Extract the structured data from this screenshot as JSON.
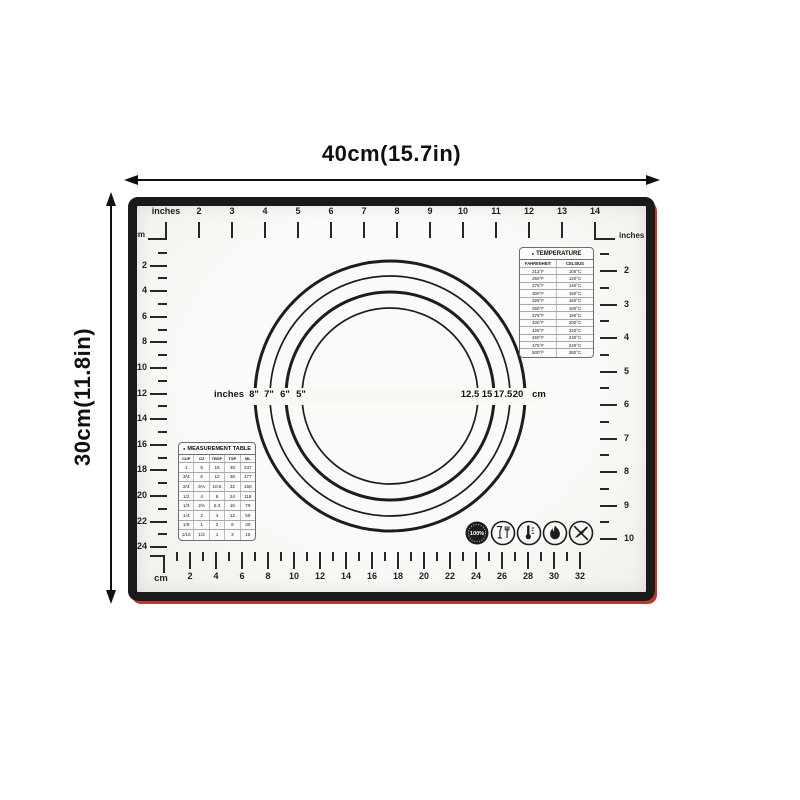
{
  "page": {
    "width_dimension": "40cm(15.7in)",
    "height_dimension": "30cm(11.8in)"
  },
  "mat": {
    "top_ruler": {
      "unit_first": "inches",
      "numbers": [
        2,
        3,
        4,
        5,
        6,
        7,
        8,
        9,
        10,
        11,
        12,
        13,
        14
      ],
      "corner_unit": "cm",
      "right_unit": "inches"
    },
    "left_ruler": {
      "numbers": [
        2,
        4,
        6,
        8,
        10,
        12,
        14,
        16,
        18,
        20,
        22,
        24
      ]
    },
    "right_ruler": {
      "numbers": [
        2,
        3,
        4,
        5,
        6,
        7,
        8,
        9,
        10
      ]
    },
    "bottom_ruler": {
      "unit": "cm",
      "numbers": [
        2,
        4,
        6,
        8,
        10,
        12,
        14,
        16,
        18,
        20,
        22,
        24,
        26,
        28,
        30,
        32
      ]
    },
    "circle_guides": {
      "left_unit": "inches",
      "diameters_inches": [
        "8\"",
        "7\"",
        "6\"",
        "5\""
      ],
      "diameters_cm": [
        "12.5",
        "15",
        "17.5",
        "20"
      ],
      "right_unit": "cm"
    },
    "temperature_table": {
      "bullet": "●",
      "title": "TEMPERATURE",
      "headers": [
        "FAHRENHEIT",
        "CELSIUS"
      ],
      "rows": [
        [
          "212°F",
          "100°C"
        ],
        [
          "250°F",
          "120°C"
        ],
        [
          "275°F",
          "140°C"
        ],
        [
          "300°F",
          "150°C"
        ],
        [
          "325°F",
          "160°C"
        ],
        [
          "350°F",
          "180°C"
        ],
        [
          "375°F",
          "190°C"
        ],
        [
          "400°F",
          "200°C"
        ],
        [
          "425°F",
          "220°C"
        ],
        [
          "450°F",
          "230°C"
        ],
        [
          "475°F",
          "240°C"
        ],
        [
          "500°F",
          "260°C"
        ]
      ]
    },
    "measurement_table": {
      "bullet": "●",
      "title": "MEASUREMENT TABLE",
      "headers": [
        "CUP",
        "OZ",
        "TBSP",
        "TSP",
        "ML"
      ],
      "rows": [
        [
          "1",
          "8",
          "16",
          "48",
          "237"
        ],
        [
          "3/4",
          "6",
          "12",
          "36",
          "177"
        ],
        [
          "2/3",
          "5⅓",
          "10.6",
          "32",
          "158"
        ],
        [
          "1/2",
          "4",
          "8",
          "24",
          "118"
        ],
        [
          "1/3",
          "2⅔",
          "5.3",
          "16",
          "79"
        ],
        [
          "1/4",
          "2",
          "4",
          "12",
          "59"
        ],
        [
          "1/8",
          "1",
          "2",
          "6",
          "30"
        ],
        [
          "1/16",
          "1/2",
          "1",
          "3",
          "15"
        ]
      ]
    },
    "badge": {
      "percent_label": "100%"
    }
  }
}
